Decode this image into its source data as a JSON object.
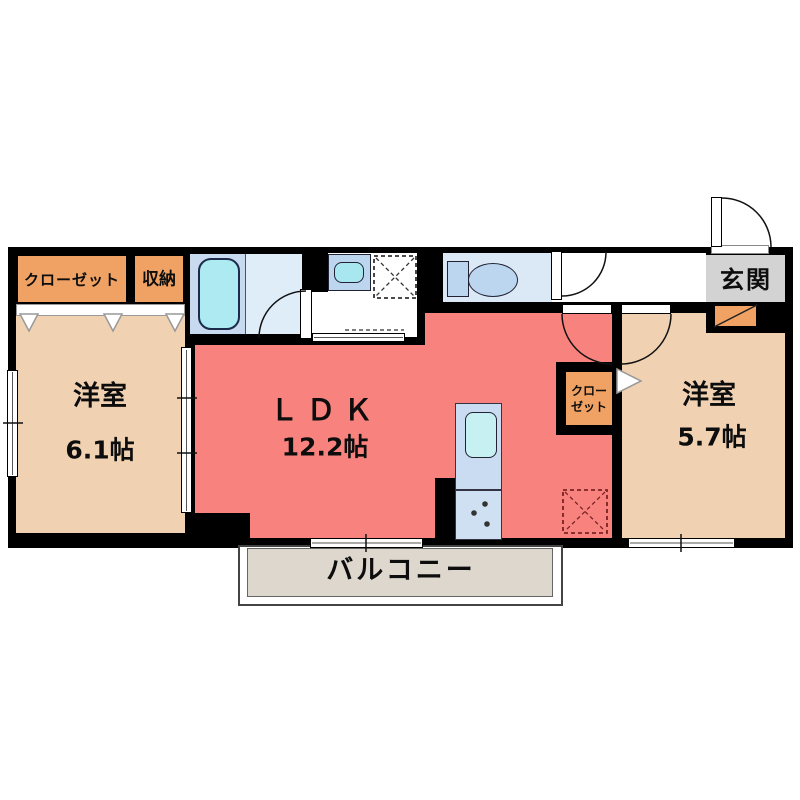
{
  "rooms": {
    "closet_left": {
      "label": "クローゼット"
    },
    "storage": {
      "label": "収納"
    },
    "bedroom_left": {
      "name": "洋室",
      "size": "6.1帖"
    },
    "ldk": {
      "name": "ＬＤＫ",
      "size": "12.2帖"
    },
    "closet_right": {
      "line1": "クロー",
      "line2": "ゼット"
    },
    "bedroom_right": {
      "name": "洋室",
      "size": "5.7帖"
    },
    "entrance": {
      "label": "玄関"
    },
    "balcony": {
      "label": "バルコニー"
    }
  },
  "fixtures": {
    "bathtub": "bathtub",
    "washbasin": "washbasin",
    "washing_machine_space": "washing-machine-space",
    "toilet": "toilet",
    "kitchen_counter": "kitchen-counter-with-sink-and-stove",
    "refrigerator_space": "refrigerator-space",
    "shoe_cabinet": "shoe-cabinet"
  },
  "colors": {
    "wall": "#000000",
    "ldk": "#f8837e",
    "room": "#f0d2b2",
    "closet": "#efa263",
    "genkan": "#d3d3d3",
    "balcony": "#ded7ce",
    "bath_a": "#c7daf0",
    "bath_b": "#dfedf9",
    "tub": "#aeeaf2",
    "fixture": "#bdd6f0",
    "toilet_room": "#dbe9f7",
    "kitchen_a": "#c9dcf2",
    "kitchen_b": "#cfe0f2",
    "sink": "#c6f0f2"
  }
}
